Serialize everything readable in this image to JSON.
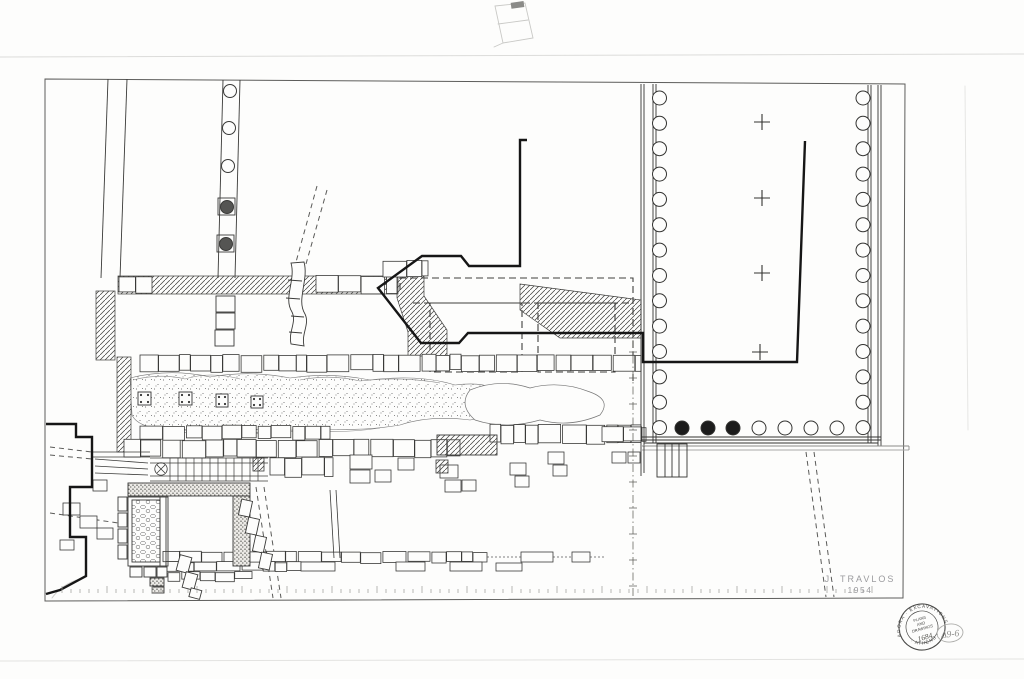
{
  "document": {
    "kind": "scanned archaeological excavation plan drawing",
    "signature": {
      "name": "J. TRAVLOS",
      "year": "1954"
    },
    "pencil_note": "Δ9-6"
  },
  "stamp": {
    "arc_top": "AGORA · EXCAVATIONS",
    "arc_bottom": "· ATHENS ·",
    "line1": "PLANS",
    "line2": "AND",
    "line3": "DRAWINGS",
    "number": "1684"
  },
  "colors": {
    "ink": "#2f2f2e",
    "heavy_ink": "#161616",
    "pencil": "#b9b9b6",
    "stamp_ink": "#4a4a48",
    "paper": "#fdfdfc"
  },
  "plan": {
    "temple": {
      "colonnade": {
        "y0": 98,
        "step": 25.35,
        "count": 14,
        "r": 7,
        "left_cx": 659.5,
        "right_cx": 863
      },
      "bottom_row": {
        "cy": 428,
        "r": 7,
        "xs": [
          682,
          708,
          733,
          759,
          785,
          811,
          837
        ],
        "filled_xs": [
          682,
          708,
          733
        ]
      },
      "crosses": [
        [
          762,
          122
        ],
        [
          762,
          198
        ],
        [
          762,
          273
        ],
        [
          760,
          352
        ]
      ]
    },
    "nw_colonnade": {
      "r": 6.5,
      "circles": [
        [
          230,
          91,
          0
        ],
        [
          229,
          128,
          0
        ],
        [
          228,
          166,
          0
        ],
        [
          227,
          207,
          1
        ],
        [
          226,
          244,
          1
        ]
      ]
    },
    "block_rows": [
      {
        "x0": 140,
        "x1": 641,
        "y": 355,
        "h": 16
      },
      {
        "x0": 124,
        "x1": 460,
        "y": 440,
        "h": 17
      },
      {
        "x0": 140,
        "x1": 330,
        "y": 426,
        "h": 13
      },
      {
        "x0": 490,
        "x1": 641,
        "y": 425,
        "h": 18
      },
      {
        "x0": 163,
        "x1": 487,
        "y": 552,
        "h": 10
      },
      {
        "x0": 166,
        "x1": 301,
        "y": 562,
        "h": 9
      },
      {
        "x0": 168,
        "x1": 252,
        "y": 572,
        "h": 8
      },
      {
        "x0": 270,
        "x1": 333,
        "y": 458,
        "h": 18
      },
      {
        "x0": 119,
        "x1": 152,
        "y": 277,
        "h": 16
      },
      {
        "x0": 316,
        "x1": 397,
        "y": 276,
        "h": 17
      },
      {
        "x0": 383,
        "x1": 428,
        "y": 261,
        "h": 16
      },
      {
        "x0": 602,
        "x1": 646,
        "y": 427,
        "h": 14
      }
    ],
    "scale_ticks": {
      "x0": 62,
      "x1": 874,
      "y": 593,
      "step": 9,
      "tall_every": 5
    },
    "survey_line": {
      "x": 633,
      "y0": 340,
      "y1": 598,
      "cross_step": 26
    }
  }
}
